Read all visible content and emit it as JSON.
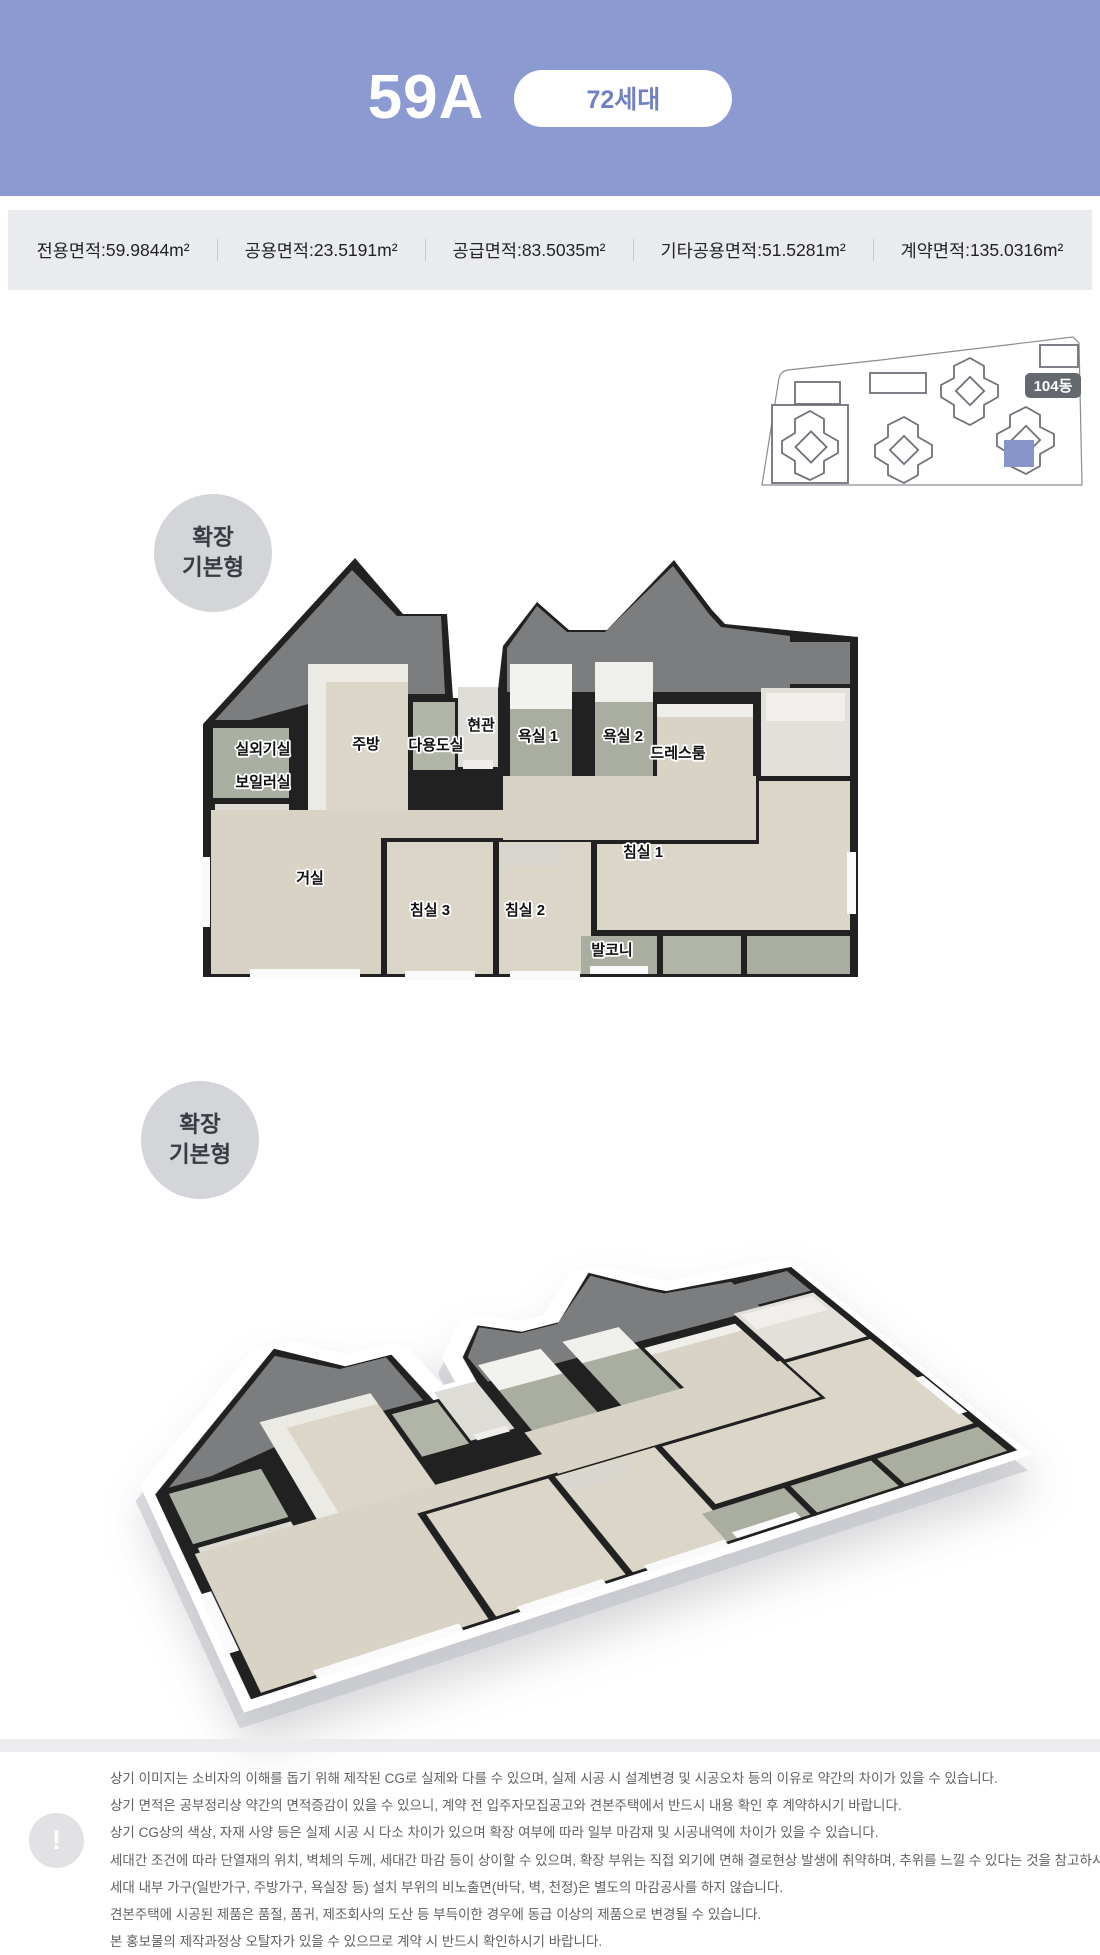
{
  "header": {
    "unit_type": "59A",
    "households_badge": "72세대"
  },
  "ui": {
    "colon": " : "
  },
  "area_specs": [
    {
      "label": "전용면적",
      "value": "59.9844m²"
    },
    {
      "label": "공용면적",
      "value": "23.5191m²"
    },
    {
      "label": "공급면적",
      "value": "83.5035m²"
    },
    {
      "label": "기타공용면적",
      "value": "51.5281m²"
    },
    {
      "label": "계약면적",
      "value": "135.0316m²"
    }
  ],
  "site_plan": {
    "building_label": "104동",
    "highlight_color": "#8795cb"
  },
  "plan_2d": {
    "badge": {
      "line1": "확장",
      "line2": "기본형"
    },
    "rooms": [
      {
        "label": "실외기실"
      },
      {
        "label": "보일러실"
      },
      {
        "label": "주방"
      },
      {
        "label": "다용도실"
      },
      {
        "label": "현관"
      },
      {
        "label": "욕실 1"
      },
      {
        "label": "욕실 2"
      },
      {
        "label": "드레스룸"
      },
      {
        "label": "거실"
      },
      {
        "label": "침실 3"
      },
      {
        "label": "침실 2"
      },
      {
        "label": "침실 1"
      },
      {
        "label": "발코니"
      }
    ]
  },
  "plan_3d": {
    "badge": {
      "line1": "확장",
      "line2": "기본형"
    }
  },
  "disclaimer": {
    "icon": "!",
    "lines": [
      "상기 이미지는 소비자의 이해를 돕기 위해 제작된 CG로 실제와 다를 수 있으며, 실제 시공 시 설계변경 및 시공오차 등의 이유로 약간의 차이가 있을 수 있습니다.",
      "상기 면적은 공부정리상 약간의 면적증감이 있을 수 있으니, 계약 전 입주자모집공고와 견본주택에서 반드시 내용 확인 후 계약하시기 바랍니다.",
      "상기 CG상의 색상, 자재 사양 등은 실제 시공 시 다소 차이가 있으며 확장 여부에 따라 일부 마감재 및 시공내역에 차이가 있을 수 있습니다.",
      "세대간 조건에 따라 단열재의 위치, 벽체의 두께, 세대간 마감 등이 상이할 수 있으며, 확장 부위는 직접 외기에 면해 결로현상 발생에 취약하며, 추위를 느낄 수 있다는 것을 참고하시기 바랍니다.",
      "세대 내부 가구(일반가구, 주방가구, 욕실장 등) 설치 부위의 비노출면(바닥, 벽, 천정)은 별도의 마감공사를 하지 않습니다.",
      "견본주택에 시공된 제품은 품절, 품귀, 제조회사의 도산 등 부득이한 경우에 동급 이상의 제품으로 변경될 수 있습니다.",
      "본 홍보물의 제작과정상 오탈자가 있을 수 있으므로 계약 시 반드시 확인하시기 바랍니다."
    ]
  },
  "colors": {
    "header_blue": "#8c9ad2",
    "pill_text": "#7080c4",
    "spec_bg": "#eaebef",
    "wall": "#212121",
    "attic_gray": "#7b7d7f",
    "wood_floor": "#d9d3c5",
    "tile": "#a9aea0"
  }
}
